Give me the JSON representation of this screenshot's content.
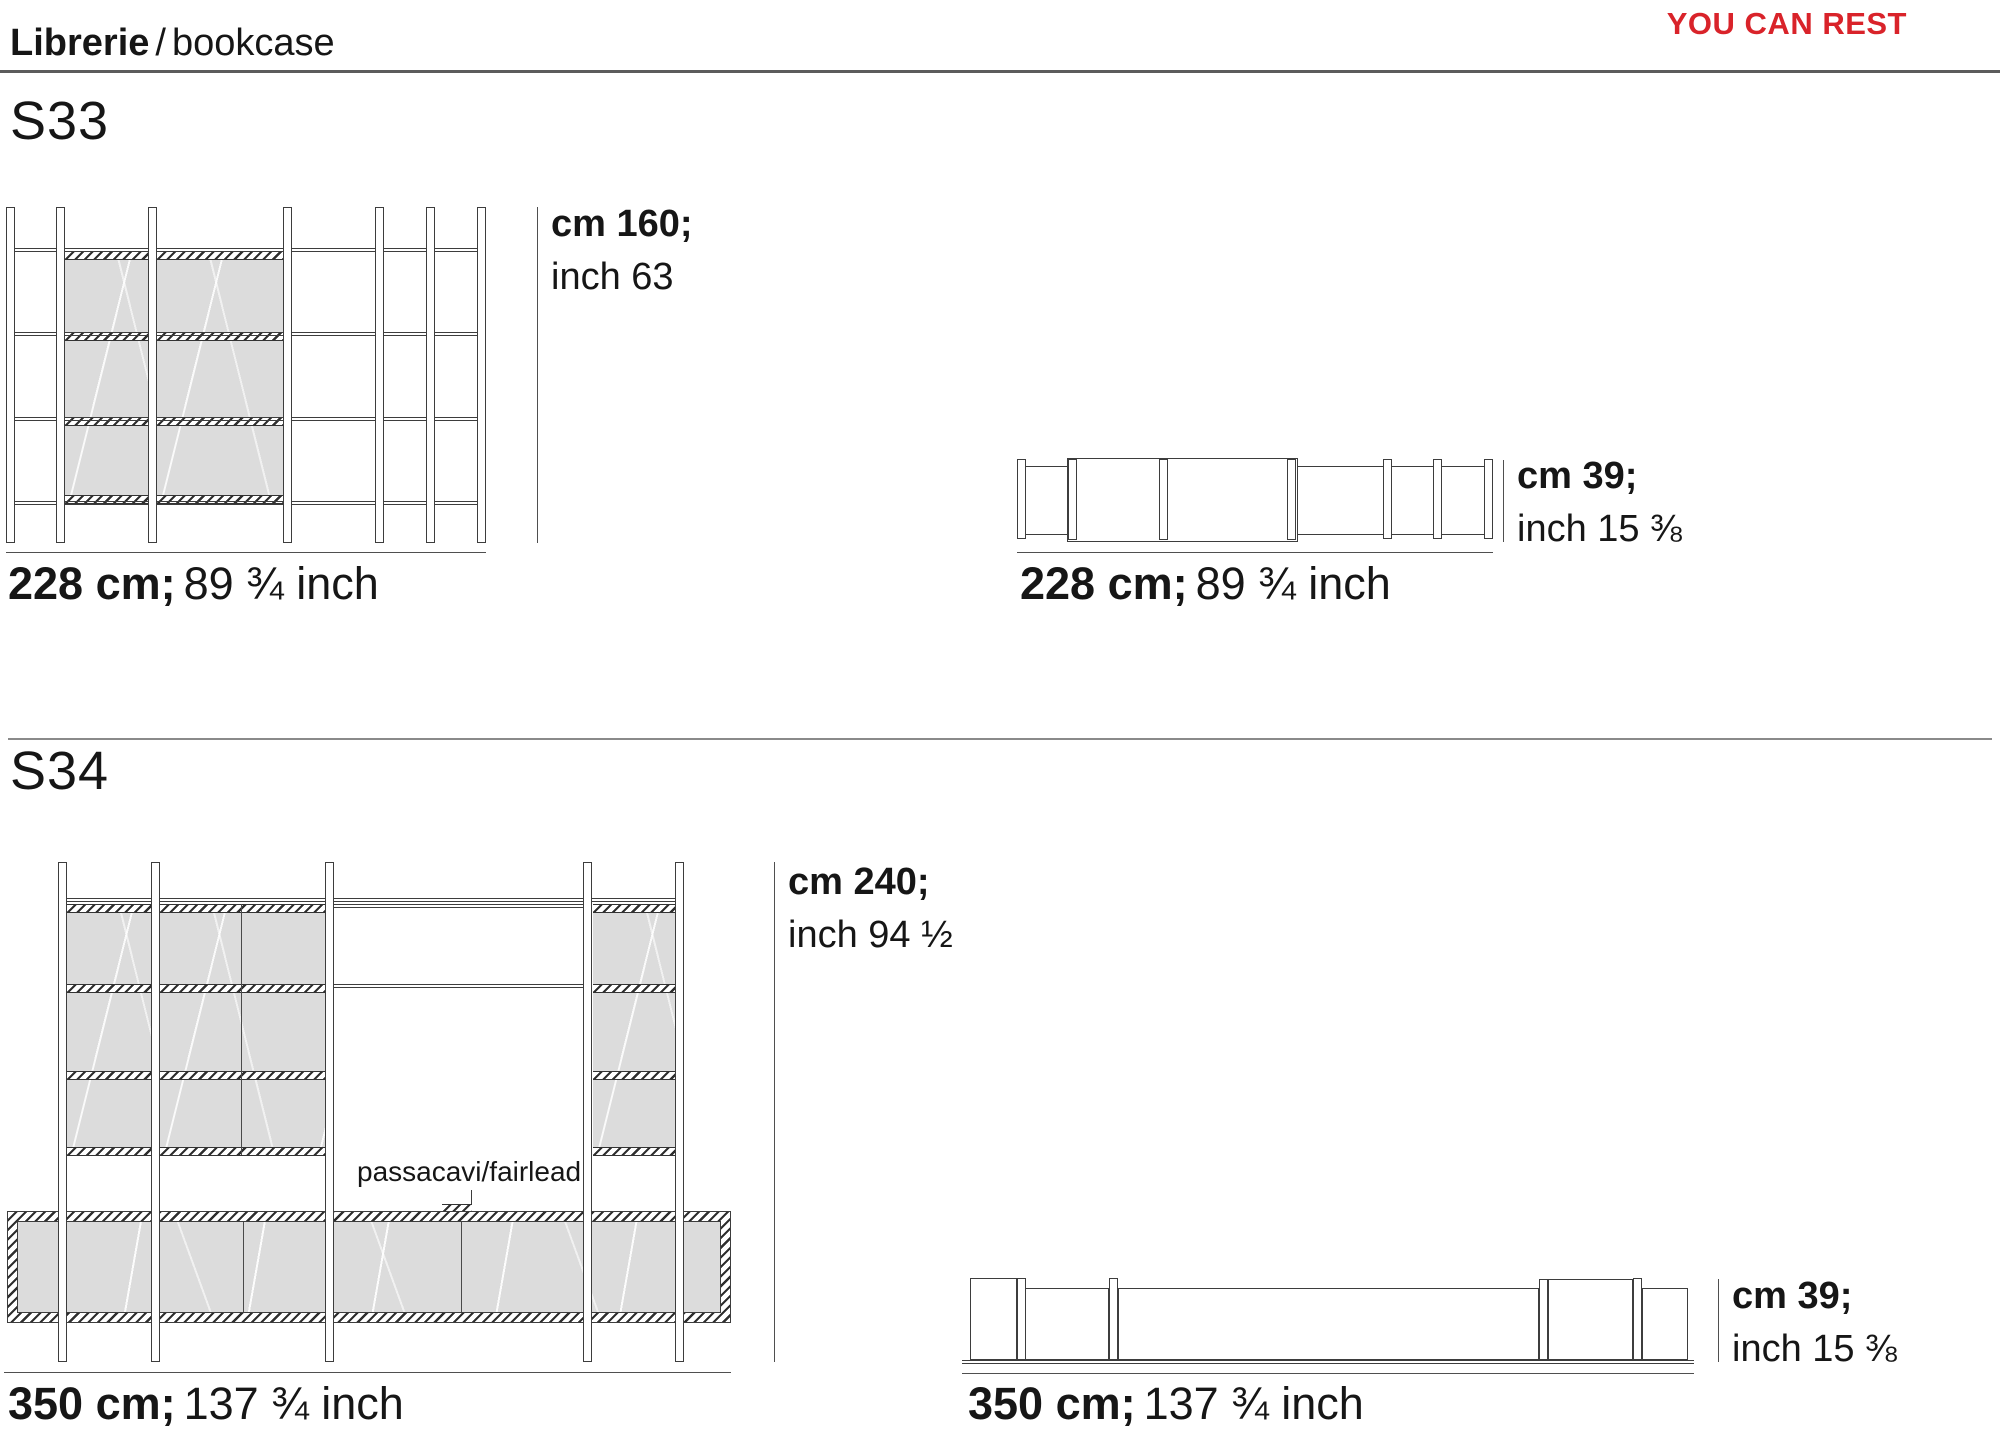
{
  "header": {
    "title_it": "Librerie",
    "separator": "/",
    "title_en": "bookcase",
    "tagline": "YOU CAN REST",
    "tagline_color": "#d9232a"
  },
  "models": [
    {
      "code": "S33",
      "front": {
        "width_cm": "228 cm;",
        "width_inch": "89 ¾ inch",
        "height_cm": "cm 160;",
        "height_inch": "inch 63"
      },
      "top": {
        "width_cm": "228 cm;",
        "width_inch": "89 ¾ inch",
        "depth_cm": "cm 39;",
        "depth_inch": "inch 15 ⅜"
      }
    },
    {
      "code": "S34",
      "annotation": "passacavi/fairlead",
      "front": {
        "width_cm": "350 cm;",
        "width_inch": "137 ¾ inch",
        "height_cm": "cm 240;",
        "height_inch": "inch 94 ½"
      },
      "top": {
        "width_cm": "350 cm;",
        "width_inch": "137 ¾ inch",
        "depth_cm": "cm 39;",
        "depth_inch": "inch 15 ⅜"
      }
    }
  ]
}
